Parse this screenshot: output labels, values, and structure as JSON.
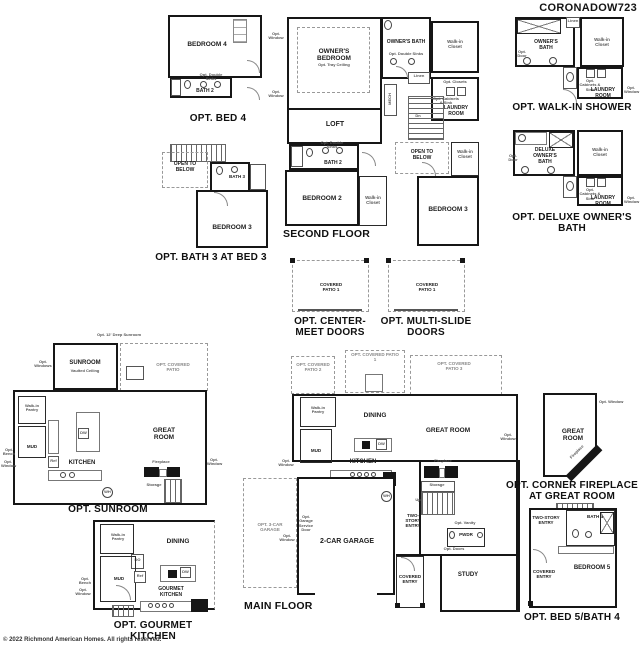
{
  "colors": {
    "paper": "#ffffff",
    "ink": "#161616",
    "muted": "#666666"
  },
  "header": {
    "model": "CORONADOW723"
  },
  "footer": {
    "copyright": "© 2022 Richmond American Homes. All rights reserved."
  },
  "plans": {
    "bed4": {
      "caption": "OPT. BED 4",
      "bedroom": "BEDROOM 4",
      "bath": "BATH 2",
      "opt_sinks": "Opt. Double Sinks"
    },
    "second": {
      "caption": "SECOND FLOOR",
      "owners_bedroom": "OWNER'S BEDROOM",
      "tray": "Opt. Tray Ceiling",
      "owners_bath": "OWNER'S BATH",
      "opt_sinks": "Opt. Double Sinks",
      "wic": "Walk-in Closet",
      "linen": "Linen",
      "mech": "MECH",
      "laundry": "LAUNDRY ROOM",
      "opt_closets": "Opt. Closets",
      "opt_cabinets": "Opt. Cabinets & Sink",
      "loft": "LOFT",
      "dn": "Dn",
      "open_below": "OPEN TO BELOW",
      "bath2": "BATH 2",
      "bath2_sinks": "Opt. Double Sinks",
      "bedroom2": "BEDROOM 2",
      "wic2": "Walk-in Closet",
      "bedroom3": "BEDROOM 3",
      "wic3": "Walk-in Closet",
      "opt_window": "Opt. Window"
    },
    "walkin": {
      "caption": "OPT. WALK-IN SHOWER",
      "bath": "OWNER'S BATH",
      "linen": "Linen",
      "wic": "Walk-in Closet",
      "laundry": "LAUNDRY ROOM",
      "opt_cabinets": "Opt. Cabinets & Sink",
      "opt_door": "Opt. Door",
      "opt_window": "Opt. Window"
    },
    "deluxe": {
      "caption": "OPT. DELUXE OWNER'S BATH",
      "bath": "DELUXE OWNER'S BATH",
      "wic": "Walk-in Closet",
      "laundry": "LAUNDRY ROOM",
      "opt_cabinets": "Opt. Cabinets & Sink",
      "opt_door": "Opt. Door",
      "opt_window": "Opt. Window"
    },
    "bath3": {
      "caption": "OPT. BATH 3 AT BED 3",
      "open_below": "OPEN TO BELOW",
      "bath": "BATH 3",
      "bedroom": "BEDROOM 3"
    },
    "center_meet": {
      "caption": "OPT. CENTER-MEET DOORS",
      "patio": "COVERED PATIO 1"
    },
    "multi_slide": {
      "caption": "OPT. MULTI-SLIDE DOORS",
      "patio": "COVERED PATIO 1"
    },
    "sunroom": {
      "caption": "OPT. SUNROOM",
      "deep": "Opt. 12' Deep Sunroom",
      "name": "SUNROOM",
      "vaulted": "Vaulted Ceiling",
      "opt_windows": "Opt. Windows",
      "patio": "OPT. COVERED PATIO",
      "pantry": "Walk-in Pantry",
      "mud": "MUD",
      "opt_bench": "Opt. Bench",
      "kitchen": "KITCHEN",
      "great_room": "GREAT ROOM",
      "fireplace": "Fireplace",
      "storage": "Storage",
      "ref": "Ref",
      "dw": "DW",
      "wh": "WH",
      "opt_window": "Opt. Window"
    },
    "main": {
      "caption": "MAIN FLOOR",
      "patio1": "OPT. COVERED PATIO 1",
      "patio2": "OPT. COVERED PATIO 2",
      "patio3": "OPT. COVERED PATIO 3",
      "pantry": "Walk-in Pantry",
      "dining": "DINING",
      "great_room": "GREAT ROOM",
      "mud": "MUD",
      "kitchen": "KITCHEN",
      "garage": "2-CAR GARAGE",
      "opt_garage": "OPT. 3-CAR GARAGE",
      "service_door": "Opt. Garage Service Door",
      "entry": "TWO-STORY ENTRY",
      "pwdr": "PWDR",
      "opt_vanity": "Opt. Vanity",
      "up": "Up",
      "fireplace": "Fireplace",
      "storage": "Storage",
      "study": "STUDY",
      "opt_doors": "Opt. Doors",
      "covered_entry": "COVERED ENTRY",
      "opt_window": "Opt. Window",
      "dw": "DW",
      "wh": "WH"
    },
    "corner_fp": {
      "caption": "OPT. CORNER FIREPLACE AT GREAT ROOM",
      "great_room": "GREAT ROOM",
      "fireplace": "Fireplace",
      "opt_window": "Opt. Window"
    },
    "bed5": {
      "caption": "OPT. BED 5/BATH 4",
      "entry": "TWO-STORY ENTRY",
      "bath": "BATH 4",
      "covered_entry": "COVERED ENTRY",
      "bedroom": "BEDROOM 5"
    },
    "gourmet": {
      "caption": "OPT. GOURMET KITCHEN",
      "pantry": "Walk-in Pantry",
      "dining": "DINING",
      "mud": "MUD",
      "dbl_oven": "DO",
      "ref": "Ref",
      "dw": "DW",
      "kitchen": "GOURMET KITCHEN",
      "opt_bench": "Opt. Bench",
      "opt_window": "Opt. Window"
    }
  }
}
